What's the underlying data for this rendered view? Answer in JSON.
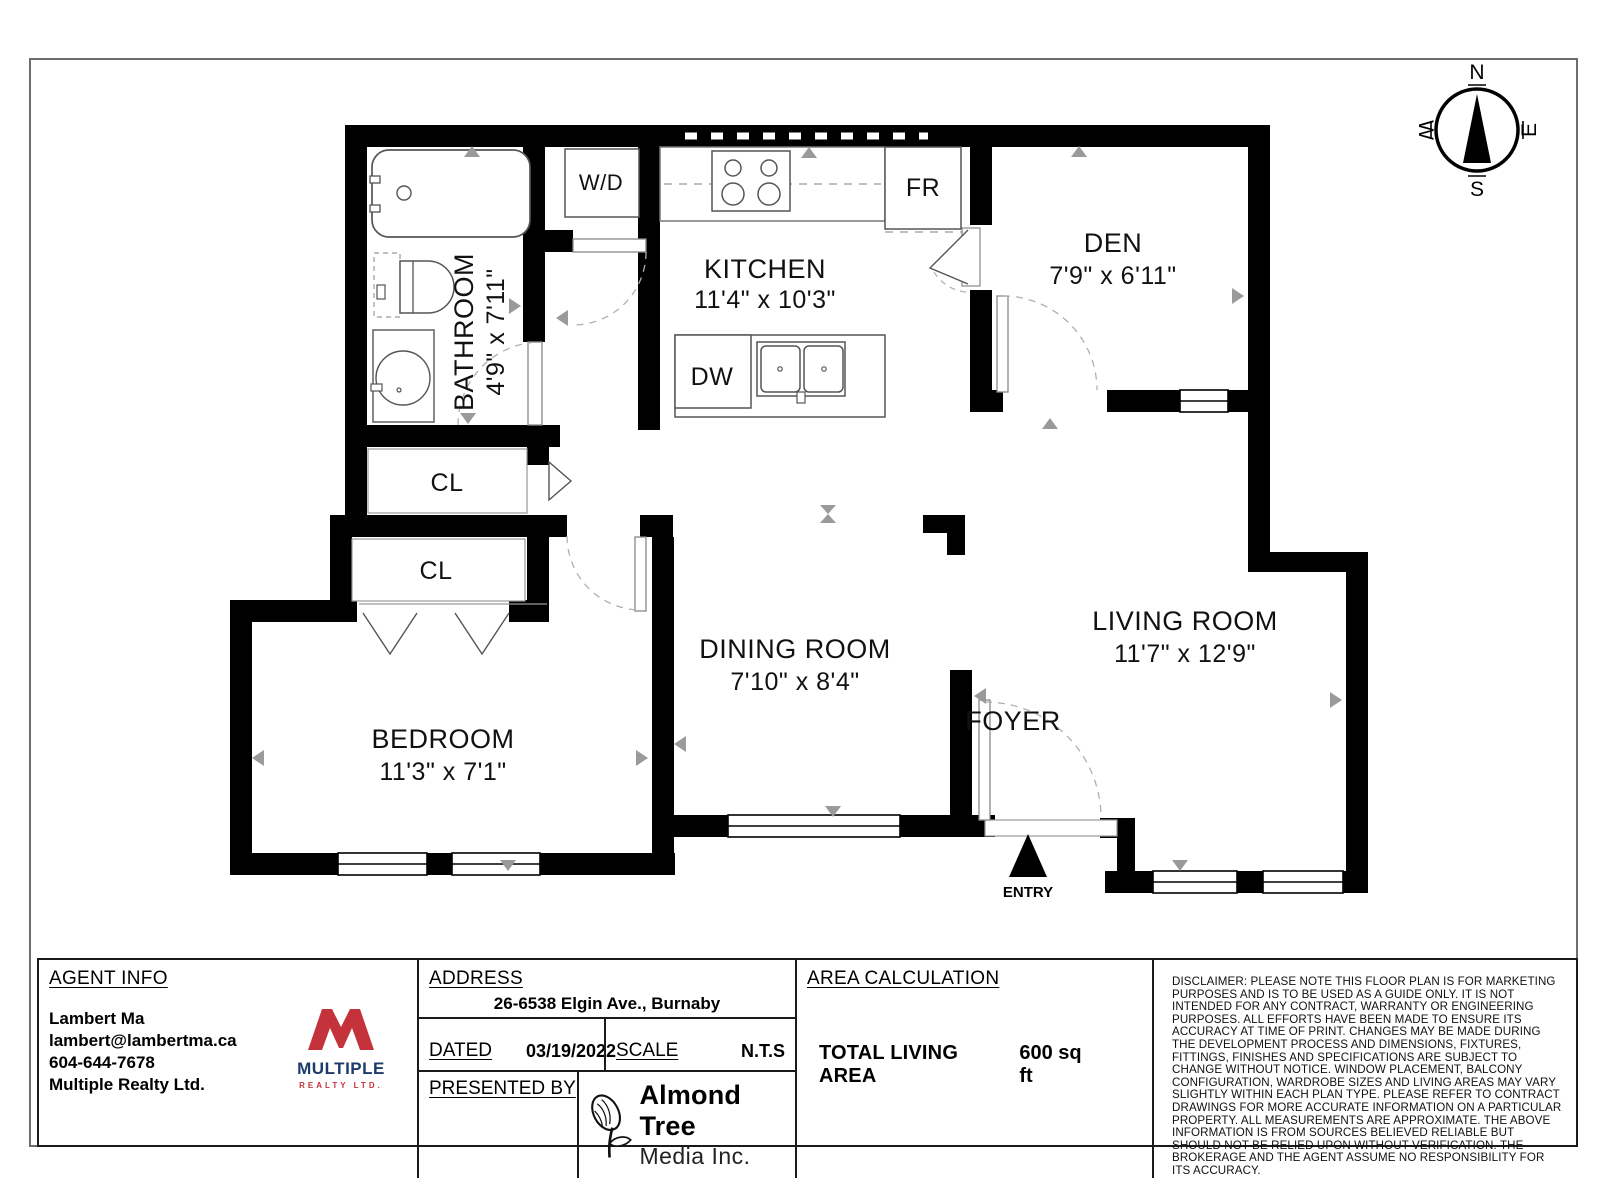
{
  "colors": {
    "wall": "#000000",
    "marker_gray": "#9a9a9a",
    "accent_red": "#c4333b",
    "accent_navy": "#1d3a6b"
  },
  "compass": {
    "n": "N",
    "e": "E",
    "s": "S",
    "w": "W"
  },
  "rooms": {
    "kitchen": {
      "name": "KITCHEN",
      "dims": "11'4\" x 10'3\""
    },
    "bathroom": {
      "name": "BATHROOM",
      "dims": "4'9\" x 7'11\""
    },
    "den": {
      "name": "DEN",
      "dims": "7'9\" x 6'11\""
    },
    "dining": {
      "name": "DINING ROOM",
      "dims": "7'10\" x 8'4\""
    },
    "bedroom": {
      "name": "BEDROOM",
      "dims": "11'3\" x 7'1\""
    },
    "living": {
      "name": "LIVING ROOM",
      "dims": "11'7\" x 12'9\""
    },
    "foyer": {
      "name": "FOYER"
    },
    "closet_hall": {
      "name": "CL"
    },
    "closet_bedroom": {
      "name": "CL"
    }
  },
  "fixtures": {
    "washer_dryer": "W/D",
    "fridge": "FR",
    "dishwasher": "DW"
  },
  "entry": {
    "label": "ENTRY"
  },
  "footer": {
    "agent": {
      "heading": "AGENT INFO",
      "name": "Lambert Ma",
      "email": "lambert@lambertma.ca",
      "phone": "604-644-7678",
      "company": "Multiple Realty Ltd."
    },
    "brokerage": {
      "word": "MULTIPLE",
      "tagline": "REALTY LTD."
    },
    "address": {
      "heading": "ADDRESS",
      "value": "26-6538 Elgin Ave., Burnaby"
    },
    "dated": {
      "label": "DATED",
      "value": "03/19/2022"
    },
    "scale": {
      "label": "SCALE",
      "value": "N.T.S"
    },
    "presented": {
      "label": "PRESENTED BY"
    },
    "media": {
      "line1": "Almond Tree",
      "line2": "Media Inc."
    },
    "area": {
      "heading": "AREA CALCULATION",
      "label": "TOTAL LIVING AREA",
      "value": "600 sq ft"
    },
    "disclaimer": "DISCLAIMER: PLEASE NOTE THIS FLOOR PLAN IS FOR MARKETING PURPOSES AND IS TO BE USED AS A GUIDE ONLY. IT IS NOT INTENDED FOR ANY CONTRACT, WARRANTY OR ENGINEERING PURPOSES. ALL EFFORTS HAVE BEEN MADE TO ENSURE ITS ACCURACY AT TIME OF PRINT. CHANGES MAY BE MADE DURING THE DEVELOPMENT PROCESS AND DIMENSIONS, FIXTURES, FITTINGS, FINISHES AND SPECIFICATIONS ARE SUBJECT TO CHANGE WITHOUT NOTICE. WINDOW PLACEMENT, BALCONY CONFIGURATION, WARDROBE SIZES AND LIVING AREAS MAY VARY SLIGHTLY WITHIN EACH PLAN TYPE. PLEASE REFER TO CONTRACT DRAWINGS FOR MORE ACCURATE INFORMATION ON A PARTICULAR PROPERTY. ALL MEASUREMENTS ARE APPROXIMATE. THE ABOVE INFORMATION IS FROM SOURCES BELIEVED RELIABLE BUT SHOULD NOT BE RELIED UPON WITHOUT VERIFICATION. THE BROKERAGE AND THE AGENT ASSUME NO RESPONSIBILITY FOR ITS ACCURACY."
  }
}
